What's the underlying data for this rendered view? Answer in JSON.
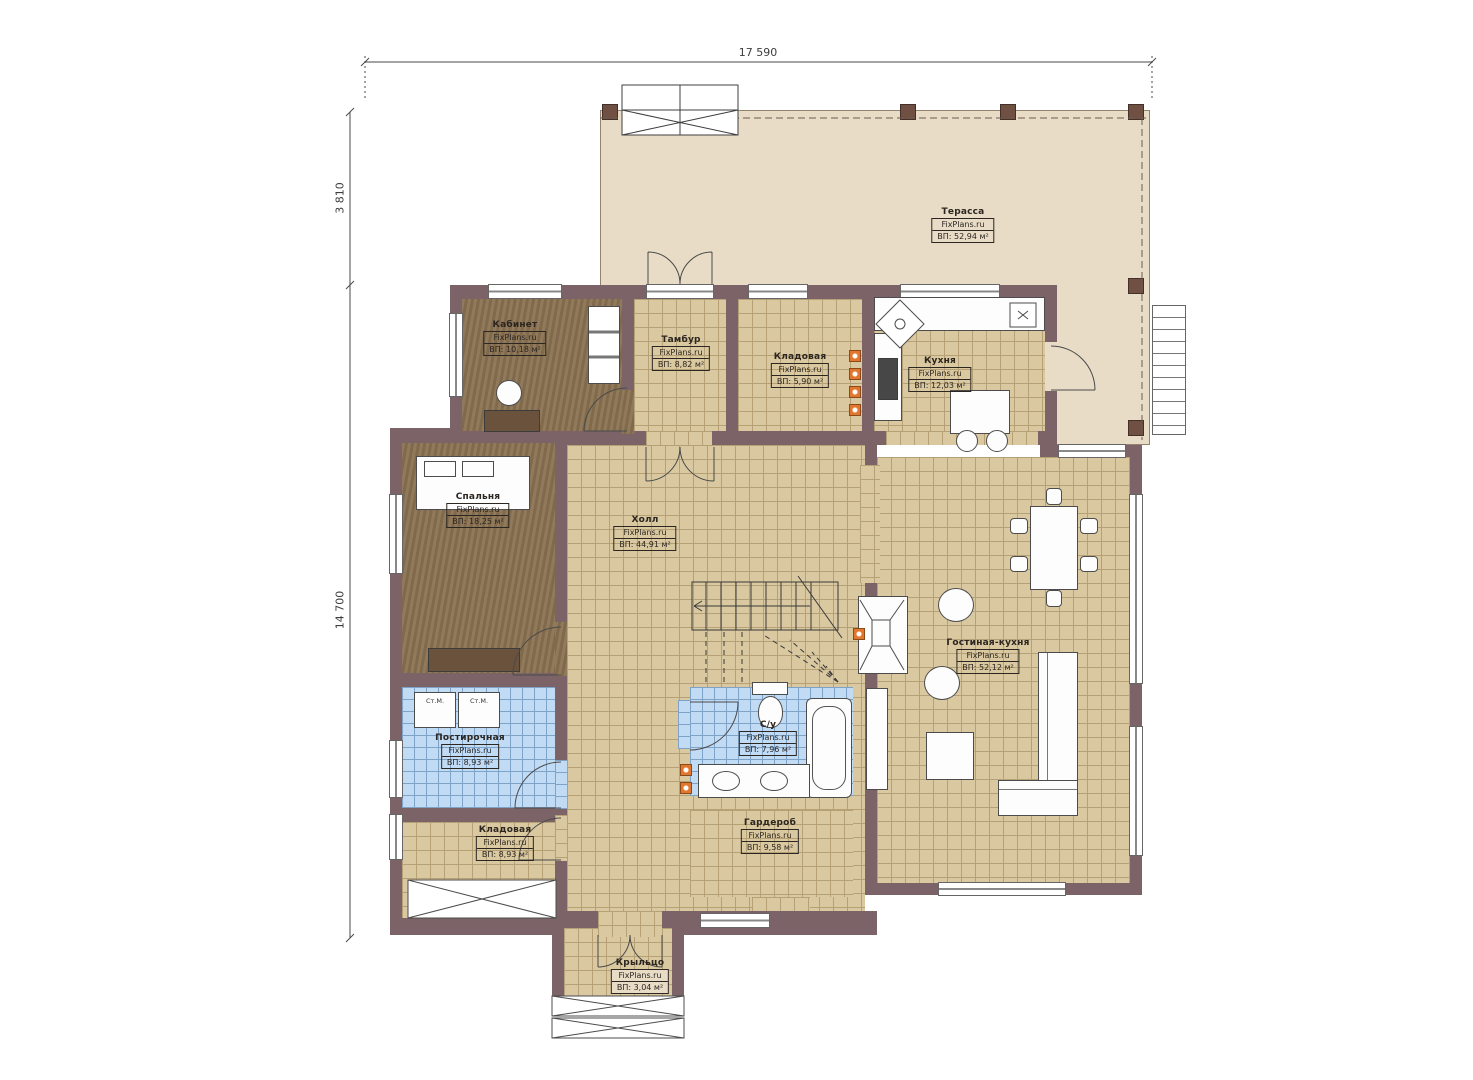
{
  "title": "План 1-го этажа",
  "dimensions": {
    "top_width": "17 590",
    "left_upper": "3 810",
    "left_lower": "14 700"
  },
  "brand": "FixPlans.ru",
  "rooms": {
    "terrace": {
      "name": "Терасса",
      "brand": "FixPlans.ru",
      "area": "ВП: 52,94 м²"
    },
    "office": {
      "name": "Кабинет",
      "brand": "FixPlans.ru",
      "area": "ВП: 10,18 м²"
    },
    "tambour": {
      "name": "Тамбур",
      "brand": "FixPlans.ru",
      "area": "ВП: 8,82 м²"
    },
    "pantry_top": {
      "name": "Кладовая",
      "brand": "FixPlans.ru",
      "area": "ВП: 5,90 м²"
    },
    "kitchen": {
      "name": "Кухня",
      "brand": "FixPlans.ru",
      "area": "ВП: 12,03 м²"
    },
    "bedroom": {
      "name": "Спальня",
      "brand": "FixPlans.ru",
      "area": "ВП: 18,25 м²"
    },
    "hall": {
      "name": "Холл",
      "brand": "FixPlans.ru",
      "area": "ВП: 44,91 м²"
    },
    "living": {
      "name": "Гостиная-кухня",
      "brand": "FixPlans.ru",
      "area": "ВП: 52,12 м²"
    },
    "laundry": {
      "name": "Постирочная",
      "brand": "FixPlans.ru",
      "area": "ВП: 8,93 м²"
    },
    "pantry_bottom": {
      "name": "Кладовая",
      "brand": "FixPlans.ru",
      "area": "ВП: 8,93 м²"
    },
    "bathroom": {
      "name": "С/у",
      "brand": "FixPlans.ru",
      "area": "ВП: 7,96 м²"
    },
    "wardrobe": {
      "name": "Гардероб",
      "brand": "FixPlans.ru",
      "area": "ВП: 9,58 м²"
    },
    "porch": {
      "name": "Крыльцо",
      "brand": "FixPlans.ru",
      "area": "ВП: 3,04 м²"
    }
  },
  "annotations": {
    "washer": "Ст.М."
  },
  "colors": {
    "wall": "#7b6367",
    "floor_tile": "#d9c8a0",
    "floor_wood": "#8b7252",
    "floor_blue": "#c2dbf4",
    "terrace": "#e8dcc7",
    "accent_orange": "#e2762d"
  }
}
